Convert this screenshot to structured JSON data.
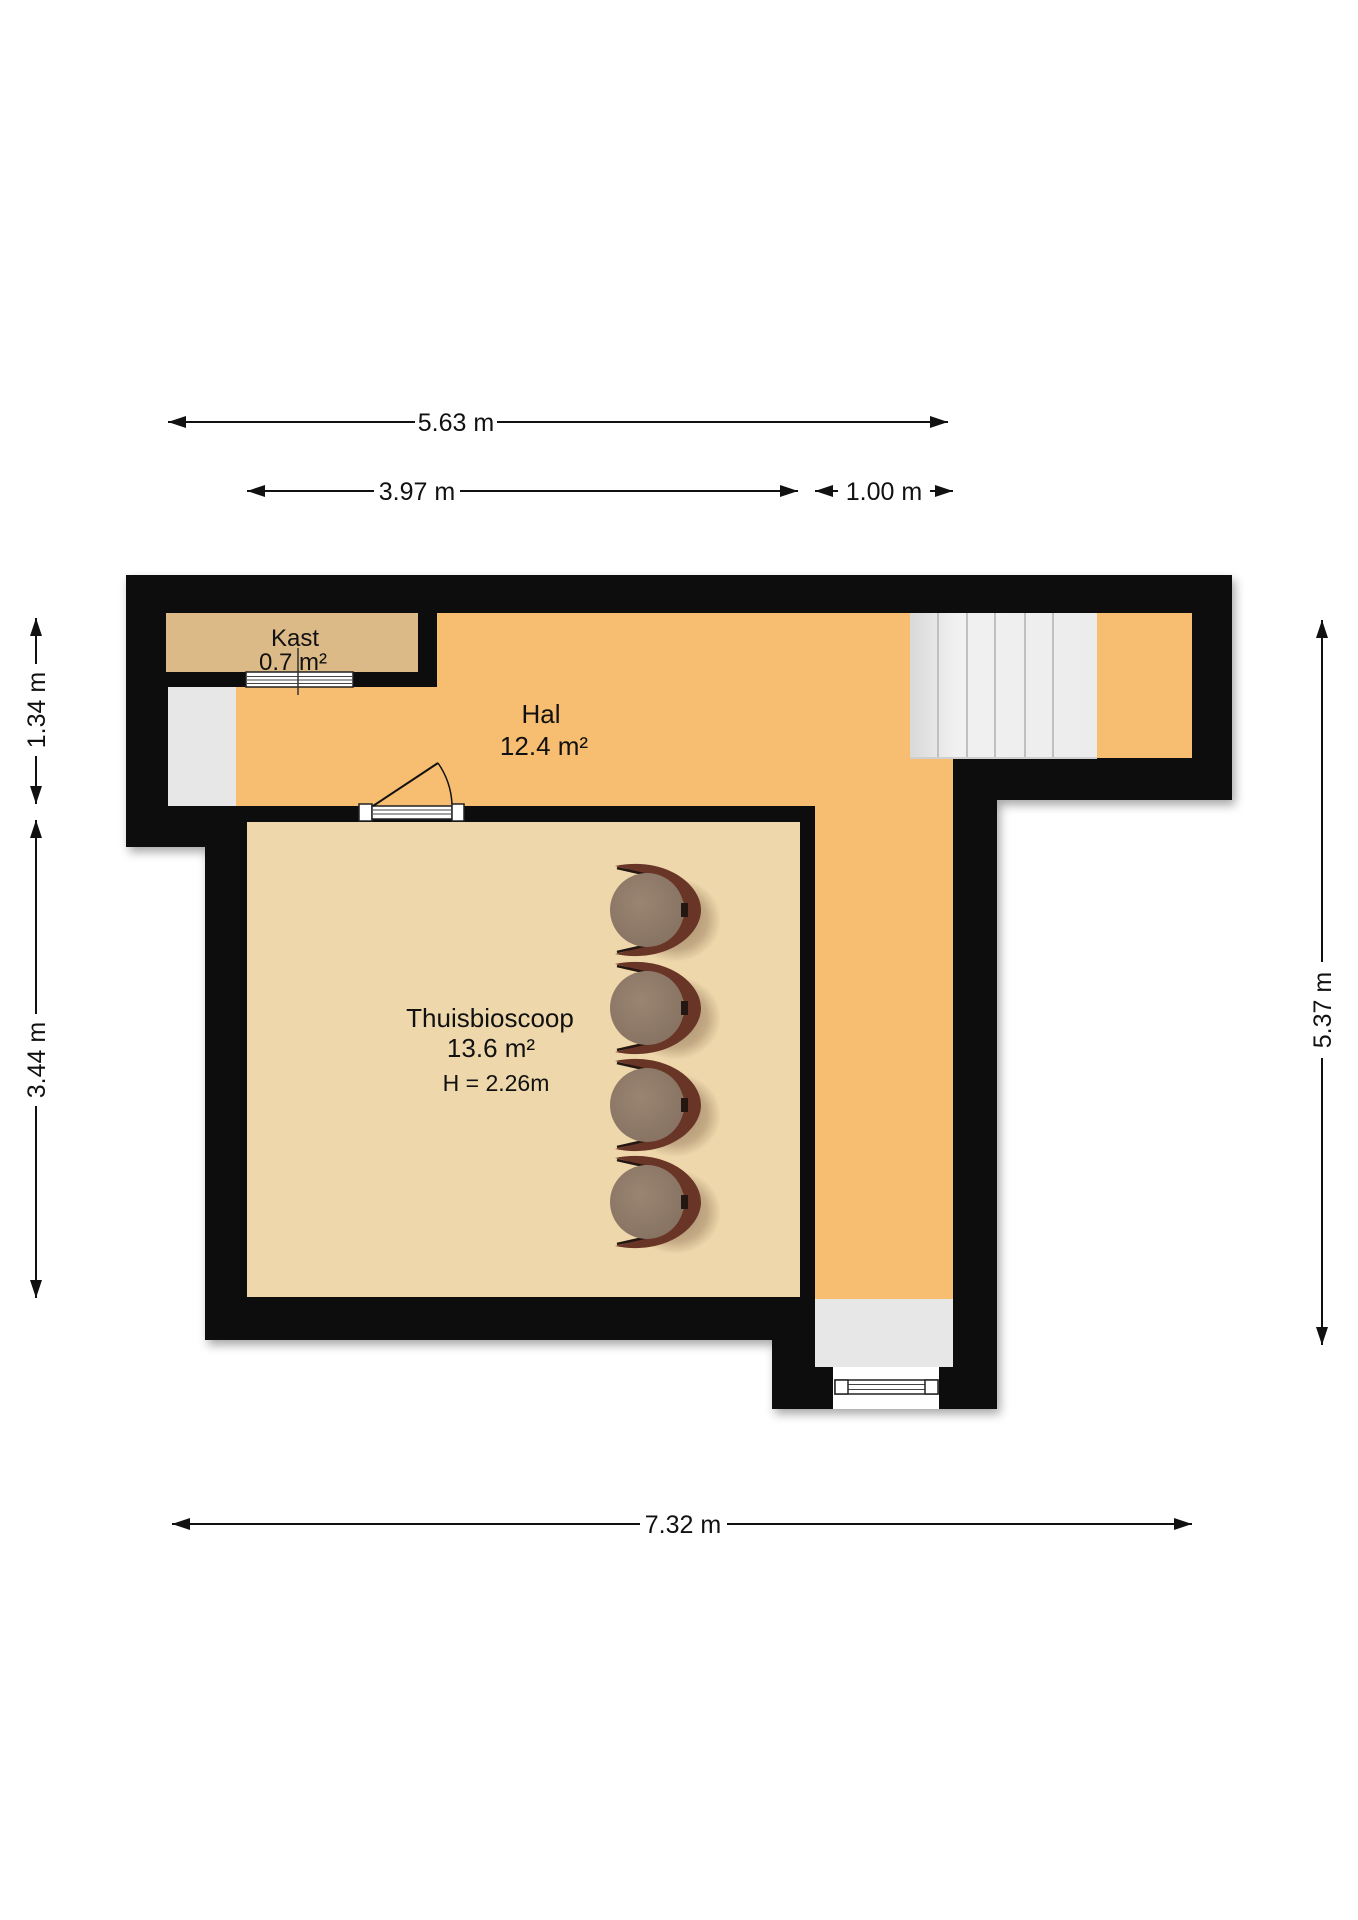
{
  "rooms": {
    "kast": {
      "name": "Kast",
      "area": "0.7 m²"
    },
    "hal": {
      "name": "Hal",
      "area": "12.4 m²"
    },
    "thuisbioscoop": {
      "name": "Thuisbioscoop",
      "area": "13.6 m²",
      "ceiling_height": "H = 2.26m"
    }
  },
  "dimensions": {
    "top_total_width": "5.63 m",
    "top_room_width": "3.97 m",
    "top_corridor_width": "1.00 m",
    "left_upper_height": "1.34 m",
    "left_lower_height": "3.44 m",
    "right_height": "5.37 m",
    "bottom_width": "7.32 m"
  },
  "colors": {
    "wall": "#0d0d0d",
    "hall_floor": "#f7bd70",
    "room_floor": "#eed7ab",
    "closet_floor": "#dcba88",
    "recess": "#e7e7e7",
    "stairs": "#ededed",
    "stair_line": "#c0c0c0",
    "chair_back": "#693527",
    "chair_seat": "#8d7566",
    "dim_line": "#111111"
  },
  "stairs": {
    "tread_count": 6
  },
  "furniture": {
    "cinema_chair_count": 4
  }
}
